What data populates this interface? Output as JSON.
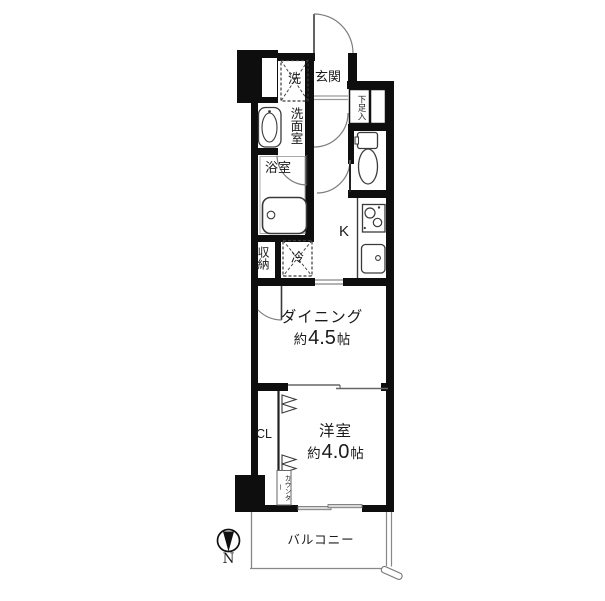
{
  "floorplan": {
    "labels": {
      "washer": "洗",
      "entrance": "玄関",
      "shoe_cabinet": "下足入",
      "washroom": "洗面室",
      "bathroom": "浴室",
      "storage": "収納",
      "refrigerator": "冷",
      "kitchen": "K",
      "closet": "CL",
      "counter": "カウンター",
      "balcony": "バルコニー",
      "compass_north": "N"
    },
    "dining": {
      "name": "ダイニング",
      "approx": "約",
      "size": "4.5",
      "unit": "帖"
    },
    "western_room": {
      "name": "洋室",
      "approx": "約",
      "size": "4.0",
      "unit": "帖"
    },
    "colors": {
      "wall": "#0e0e0e",
      "fixture_line": "#3a3a3a",
      "door_arc": "#7d7d7d",
      "opening_line": "#9a9a9a",
      "text": "#1a1a1a",
      "background": "#ffffff"
    }
  }
}
